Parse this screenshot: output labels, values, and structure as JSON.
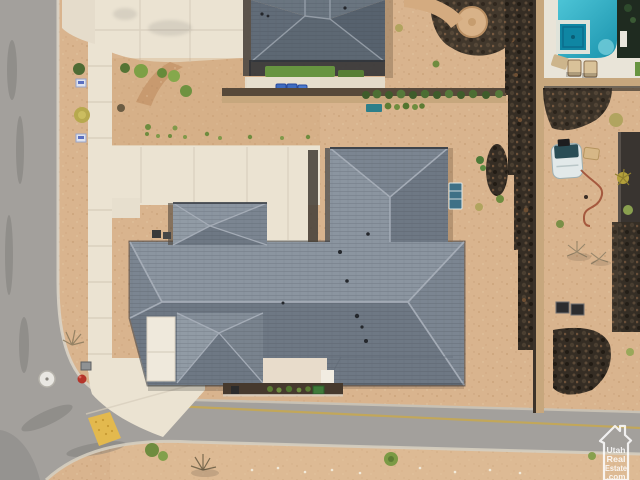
{
  "scene": {
    "type": "aerial-drone-photo",
    "subject": "New-construction desert home on a corner lot: gray hip roofs, concrete courtyard, curved street, neighbor pool and lava-rock wall"
  },
  "watermark": {
    "lines": [
      "Utah",
      "Real",
      "Estate",
      ".com"
    ]
  },
  "counts": {
    "trash_bins": 3,
    "lounge_chairs": 2,
    "ac_units": 2
  },
  "colors": {
    "sand": "#d9b48e",
    "sand_light": "#e2c29c",
    "road": "#a3a09c",
    "concrete": "#ebe3d2",
    "concrete_seam": "#d5ccba",
    "roof_light": "#8b95a0",
    "roof_mid": "#7b8591",
    "roof_dark": "#6e7884",
    "roof_ridge": "#a6aeb8",
    "neighbor_roof_light": "#6a7580",
    "neighbor_roof_dark": "#5d6873",
    "eave_shadow": "#2e3034",
    "pool_water": "#35b7cb",
    "pool_deep": "#1b93ad",
    "spa_water": "#0f86a3",
    "deck": "#e9e4d8",
    "lava_rock": "#352d24",
    "wall_tan": "#c7a77d",
    "wall_shadow": "#57493a",
    "grass": "#679440",
    "shrub": "#6f8c3f",
    "dry_shrub": "#b1a45f",
    "bin_blue": "#3e6cc0",
    "hydrant_red": "#b5342a",
    "ramp_yellow": "#e3b94e",
    "centerline_yellow": "#c9a94a",
    "white_trim": "#efe9dc",
    "entry": "#e8dccb",
    "boat_white": "#e2e9e9",
    "boat_dark": "#2a4d55",
    "hose_red": "#9e4f35",
    "window_blue": "#3f7086",
    "watermark_white": "#ffffff"
  }
}
